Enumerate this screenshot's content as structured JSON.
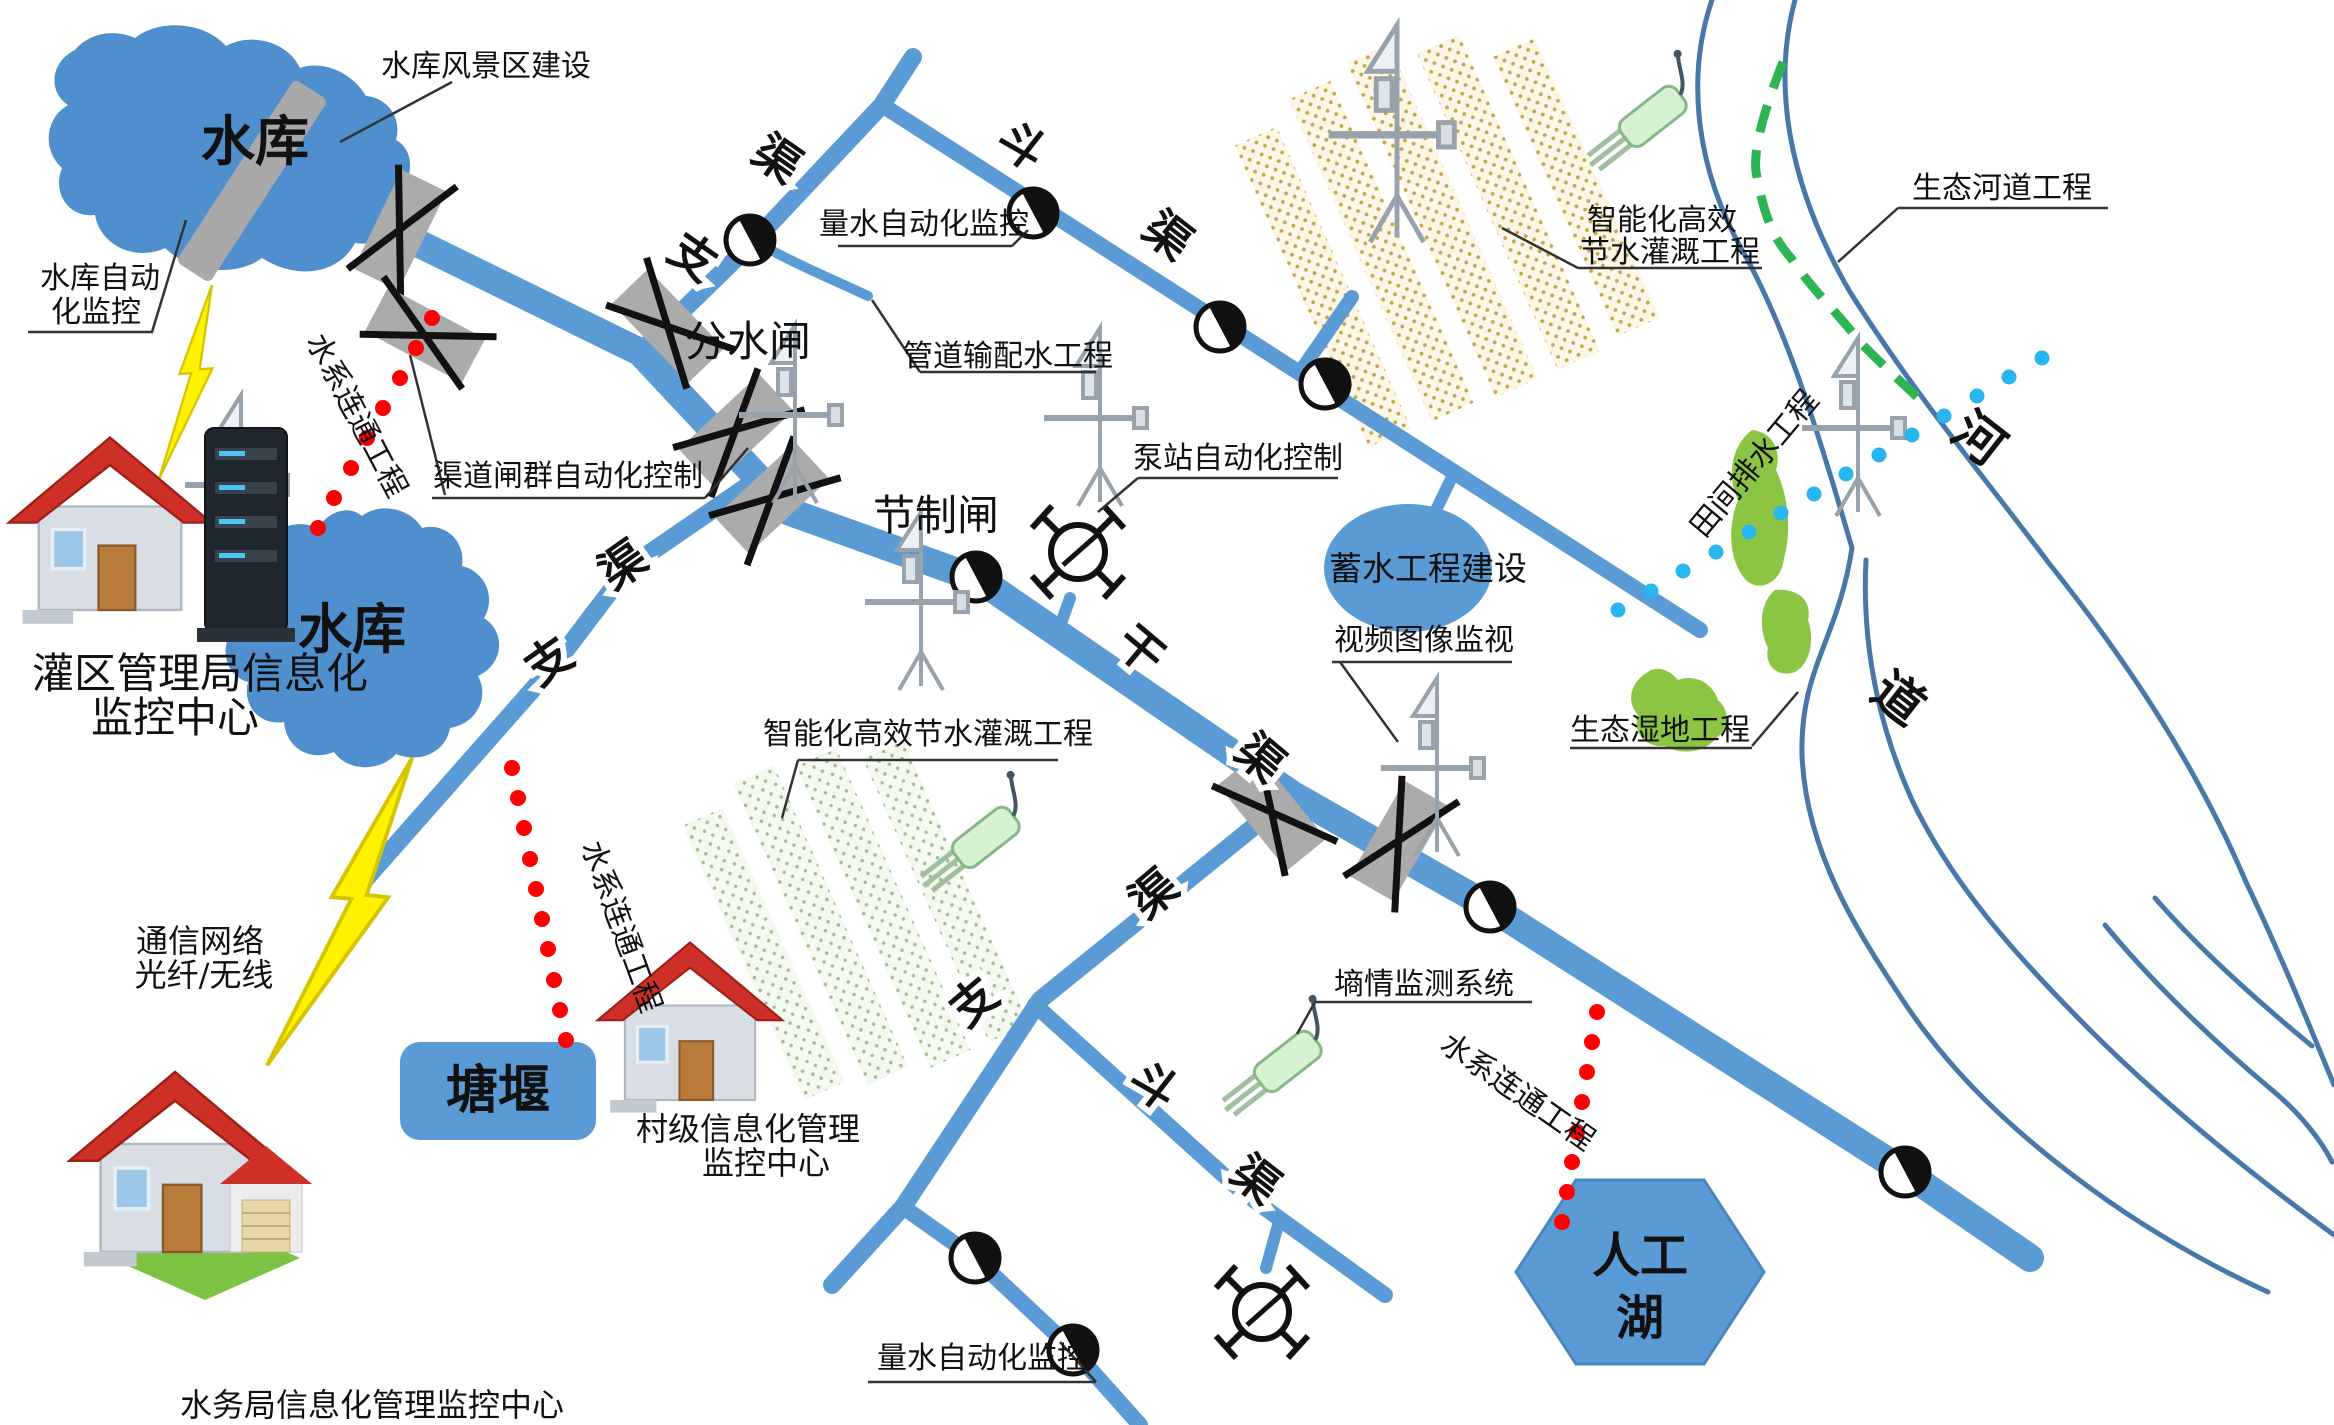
{
  "diagram": {
    "type": "irrigation-district-informatization-schematic",
    "labels": {
      "reservoir_top": "水库",
      "reservoir_left": "水库",
      "scenic": "水库风景区建设",
      "reservoir_auto_l1": "水库自动",
      "reservoir_auto_l2": "化监控",
      "admin_center_l1": "灌区管理局信息化",
      "admin_center_l2": "监控中心",
      "water_connect": "水系连通工程",
      "gate_group_auto": "渠道闸群自动化控制",
      "diversion_gate": "分水闸",
      "control_gate": "节制闸",
      "flow_monitor": "量水自动化监控",
      "pipeline": "管道输配水工程",
      "pump_auto": "泵站自动化控制",
      "smart_irrigation_l1": "智能化高效",
      "smart_irrigation_l2": "节水灌溉工程",
      "smart_irrigation_one_line": "智能化高效节水灌溉工程",
      "storage_project": "蓄水工程建设",
      "video_monitor": "视频图像监视",
      "eco_river": "生态河道工程",
      "field_drainage": "田间排水工程",
      "eco_wetland": "生态湿地工程",
      "river_char_1": "河",
      "river_char_2": "道",
      "comm_l1": "通信网络",
      "comm_l2": "光纤/无线",
      "pond": "塘堰",
      "village_center_l1": "村级信息化管理",
      "village_center_l2": "监控中心",
      "bureau_center": "水务局信息化管理监控中心",
      "soil_moisture": "墒情监测系统",
      "lake_l1": "人工",
      "lake_l2": "湖",
      "canal_main": [
        "干",
        "渠"
      ],
      "canal_branch": [
        "支",
        "渠"
      ],
      "canal_lateral": [
        "斗",
        "渠"
      ]
    },
    "colors": {
      "canal_blue": "#5B9BD5",
      "reservoir_blue": "#508FCE",
      "river_line": "#4878A8",
      "gate_gray": "#ABABAB",
      "dam_gray": "#A9A9A9",
      "connect_red": "#FF0000",
      "drain_cyan": "#29B6F0",
      "eco_dash_green": "#2EB553",
      "wetland_green": "#8CC544",
      "field_tan": "#C8A44B",
      "field_light_green": "#9DBF8E",
      "lightning_yellow": "#FFF200",
      "roof_red": "#CE2F26",
      "sensor_green": "#D8F0D4"
    },
    "icons": {
      "flow-meter-icon": "half-filled circle (water measuring point)",
      "gate-icon": "gray bar crossed with X (sluice gate)",
      "pump-icon": "circle with diagonal footed legs (pump station)",
      "monitor-tower-icon": "telemetry pole with crossbar",
      "soil-sensor-icon": "green probe with prongs",
      "lightning-icon": "yellow wireless-link bolt",
      "dam-icon": "gray dam bar",
      "house-icon": "monitoring center house",
      "server-icon": "server rack"
    }
  }
}
